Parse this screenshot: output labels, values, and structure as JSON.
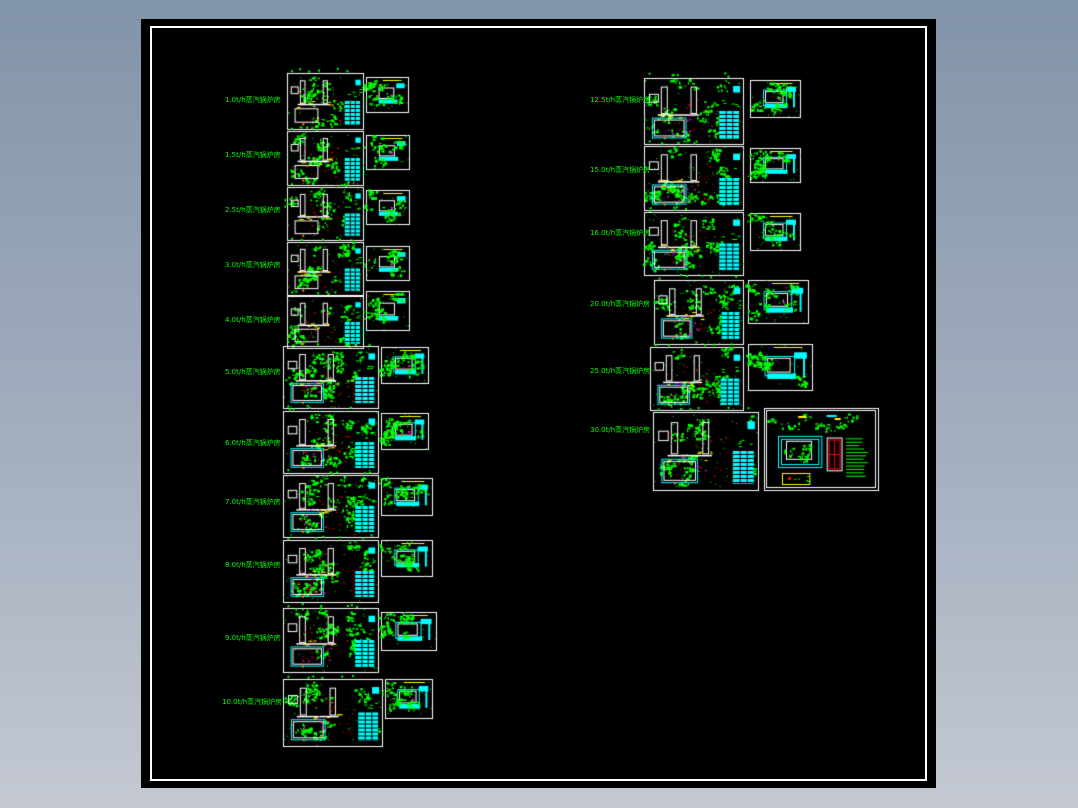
{
  "background": {
    "gradient_top": "#8294aa",
    "gradient_bottom": "#c4c9d2"
  },
  "viewport": {
    "x": 141,
    "y": 19,
    "width": 795,
    "height": 769,
    "background": "#000000",
    "frame": {
      "inset_x": 9,
      "inset_y": 7,
      "width": 777,
      "height": 755,
      "color": "#ffffff"
    }
  },
  "palette": {
    "green": "#00ff00",
    "cyan": "#00ffff",
    "red": "#ff0000",
    "yellow": "#ffff00",
    "magenta": "#ff00ff",
    "white": "#ffffff",
    "orange": "#ff8000",
    "black": "#000000"
  },
  "columns": [
    {
      "name": "left-column",
      "rows": [
        {
          "label": "1.0t/h蒸汽锅炉房",
          "label_x": 225,
          "label_y": 100,
          "main": {
            "x": 287,
            "y": 73,
            "w": 76,
            "h": 56,
            "large": false
          },
          "side": {
            "x": 366,
            "y": 77,
            "w": 42,
            "h": 35,
            "large": false
          }
        },
        {
          "label": "1.5t/h蒸汽锅炉房",
          "label_x": 225,
          "label_y": 155,
          "main": {
            "x": 287,
            "y": 131,
            "w": 76,
            "h": 54,
            "large": false
          },
          "side": {
            "x": 366,
            "y": 135,
            "w": 43,
            "h": 34,
            "large": false
          }
        },
        {
          "label": "2.5t/h蒸汽锅炉房",
          "label_x": 225,
          "label_y": 210,
          "main": {
            "x": 287,
            "y": 187,
            "w": 76,
            "h": 53,
            "large": false
          },
          "side": {
            "x": 366,
            "y": 190,
            "w": 43,
            "h": 34,
            "large": false
          }
        },
        {
          "label": "3.0t/h蒸汽锅炉房",
          "label_x": 225,
          "label_y": 265,
          "main": {
            "x": 287,
            "y": 242,
            "w": 76,
            "h": 53,
            "large": false
          },
          "side": {
            "x": 366,
            "y": 246,
            "w": 43,
            "h": 34,
            "large": false
          }
        },
        {
          "label": "4.0t/h蒸汽锅炉房",
          "label_x": 225,
          "label_y": 320,
          "main": {
            "x": 287,
            "y": 296,
            "w": 76,
            "h": 52,
            "large": false
          },
          "side": {
            "x": 366,
            "y": 291,
            "w": 43,
            "h": 39,
            "large": false
          }
        },
        {
          "label": "5.0t/h蒸汽锅炉房",
          "label_x": 225,
          "label_y": 372,
          "main": {
            "x": 283,
            "y": 346,
            "w": 95,
            "h": 62,
            "large": true
          },
          "side": {
            "x": 381,
            "y": 347,
            "w": 47,
            "h": 36,
            "large": true
          }
        },
        {
          "label": "6.0t/h蒸汽锅炉房",
          "label_x": 225,
          "label_y": 443,
          "main": {
            "x": 283,
            "y": 411,
            "w": 95,
            "h": 62,
            "large": true
          },
          "side": {
            "x": 381,
            "y": 413,
            "w": 47,
            "h": 36,
            "large": true
          }
        },
        {
          "label": "7.0t/h蒸汽锅炉房",
          "label_x": 225,
          "label_y": 502,
          "main": {
            "x": 283,
            "y": 475,
            "w": 95,
            "h": 62,
            "large": true
          },
          "side": {
            "x": 381,
            "y": 478,
            "w": 51,
            "h": 37,
            "large": true
          }
        },
        {
          "label": "8.0t/h蒸汽锅炉房",
          "label_x": 225,
          "label_y": 565,
          "main": {
            "x": 283,
            "y": 540,
            "w": 95,
            "h": 62,
            "large": true
          },
          "side": {
            "x": 381,
            "y": 540,
            "w": 51,
            "h": 36,
            "large": true
          }
        },
        {
          "label": "9.0t/h蒸汽锅炉房",
          "label_x": 225,
          "label_y": 638,
          "main": {
            "x": 283,
            "y": 608,
            "w": 95,
            "h": 64,
            "large": true
          },
          "side": {
            "x": 381,
            "y": 612,
            "w": 55,
            "h": 38,
            "large": true
          }
        },
        {
          "label": "10.0t/h蒸汽锅炉房",
          "label_x": 222,
          "label_y": 702,
          "main": {
            "x": 283,
            "y": 679,
            "w": 99,
            "h": 67,
            "large": true
          },
          "side": {
            "x": 385,
            "y": 679,
            "w": 47,
            "h": 39,
            "large": true
          }
        }
      ]
    },
    {
      "name": "right-column",
      "rows": [
        {
          "label": "12.5t/h蒸汽锅炉房",
          "label_x": 590,
          "label_y": 100,
          "main": {
            "x": 644,
            "y": 78,
            "w": 99,
            "h": 66,
            "large": true
          },
          "side": {
            "x": 750,
            "y": 80,
            "w": 50,
            "h": 37,
            "large": true
          }
        },
        {
          "label": "15.0t/h蒸汽锅炉房",
          "label_x": 590,
          "label_y": 170,
          "main": {
            "x": 644,
            "y": 146,
            "w": 99,
            "h": 64,
            "large": true
          },
          "side": {
            "x": 750,
            "y": 148,
            "w": 50,
            "h": 34,
            "large": true
          }
        },
        {
          "label": "16.0t/h蒸汽锅炉房",
          "label_x": 590,
          "label_y": 233,
          "main": {
            "x": 644,
            "y": 212,
            "w": 99,
            "h": 63,
            "large": true
          },
          "side": {
            "x": 750,
            "y": 213,
            "w": 50,
            "h": 37,
            "large": true
          }
        },
        {
          "label": "20.0t/h蒸汽锅炉房",
          "label_x": 590,
          "label_y": 304,
          "main": {
            "x": 654,
            "y": 280,
            "w": 89,
            "h": 64,
            "large": true
          },
          "side": {
            "x": 748,
            "y": 280,
            "w": 60,
            "h": 43,
            "large": true
          }
        },
        {
          "label": "25.0t/h蒸汽锅炉房",
          "label_x": 590,
          "label_y": 371,
          "main": {
            "x": 650,
            "y": 347,
            "w": 93,
            "h": 63,
            "large": true
          },
          "side": {
            "x": 748,
            "y": 344,
            "w": 64,
            "h": 46,
            "large": true
          }
        },
        {
          "label": "30.0t/h蒸汽锅炉房",
          "label_x": 590,
          "label_y": 430,
          "main": {
            "x": 653,
            "y": 412,
            "w": 105,
            "h": 78,
            "large": true
          },
          "wide": {
            "x": 764,
            "y": 408,
            "w": 114,
            "h": 82
          }
        }
      ]
    }
  ]
}
